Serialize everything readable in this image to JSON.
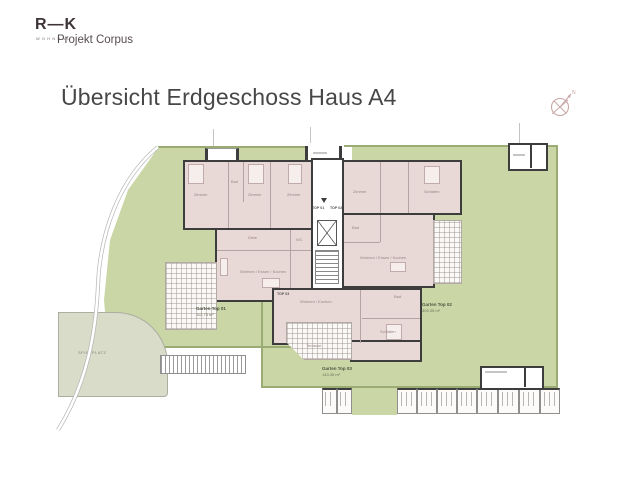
{
  "header": {
    "logo_brand": "R—K",
    "logo_sub": "WOHNBAU",
    "logo_project": "Projekt Corpus",
    "title": "Übersicht Erdgeschoss Haus A4"
  },
  "compass": {
    "label": "N"
  },
  "plan": {
    "playground_label": "SPIELPLATZ",
    "gardens": [
      {
        "name": "Garten Top 01",
        "area": "112,75 m²"
      },
      {
        "name": "Garten Top 02",
        "area": "309,35 m²"
      },
      {
        "name": "Garten Top 03",
        "area": "143,35 m²"
      }
    ],
    "units": [
      "TOP 01",
      "TOP 02",
      "TOP 03"
    ],
    "room_labels": [
      "Zimmer",
      "Bad",
      "Zimmer",
      "Zimmer",
      "Diele",
      "Wohnen / Essen / Kochen",
      "WC",
      "Zimmer",
      "Schlafen",
      "Bad",
      "Wohnen / Essen / Kochen",
      "Schlafen",
      "Wohnen / Kochen",
      "Bad",
      "Terrasse"
    ]
  },
  "colors": {
    "garden": "#cbd6a6",
    "hedge": "#9aab74",
    "room_fill": "#e8d9d7",
    "wall": "#3d3d3d",
    "playground": "#d8dcc9",
    "compass_accent": "#c8a7a7"
  }
}
